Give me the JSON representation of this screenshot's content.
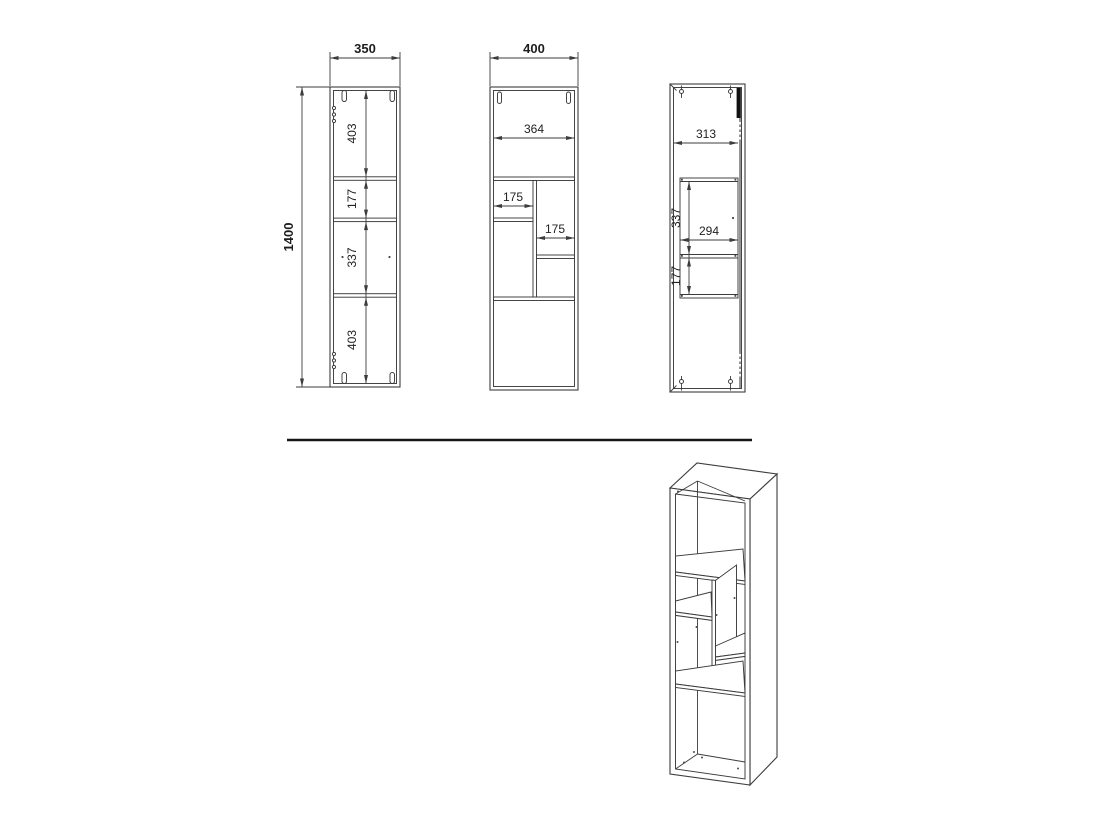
{
  "colors": {
    "background": "#ffffff",
    "line": "#3c3c3c",
    "text": "#222222",
    "divider_rule": "#161616"
  },
  "views": {
    "side_left": {
      "width": "350",
      "height": "1400",
      "sections": [
        "403",
        "177",
        "337",
        "403"
      ]
    },
    "front": {
      "width": "400",
      "inner_width": "364",
      "left_shelf_width": "175",
      "right_shelf_width": "175"
    },
    "side_right": {
      "inner_depth": "313",
      "upper_section": "337",
      "inner_width": "294",
      "lower_section": "177"
    }
  }
}
